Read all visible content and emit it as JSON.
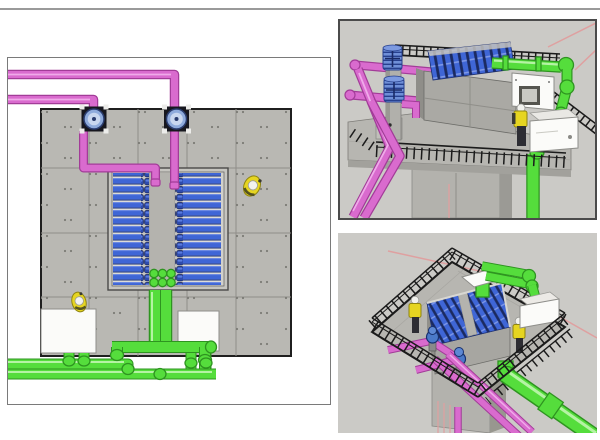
{
  "scene": {
    "name": "uv-disinfection-structure-3d-views",
    "view_count": 3
  },
  "panels": {
    "plan_view": {
      "name": "plan-view",
      "position": "left",
      "equipment": {
        "mixer_pumps": 2,
        "lamp_banks": 2,
        "lamp_modules_per_bank": 14,
        "influent_pipes_magenta": 2,
        "effluent_pipes_green": 2,
        "control_cabinets": 2,
        "workers": 2,
        "channel_drain_ports": 6
      }
    },
    "perspective_view_top": {
      "name": "elevated-structure-perspective",
      "position": "top-right",
      "equipment": {
        "vertical_pump_columns": 2,
        "lamp_modules_visible": 12,
        "control_cabinets": 2,
        "workers": 1,
        "magenta_drop_pipes": 2,
        "green_pipe_runs": 2
      }
    },
    "perspective_view_bottom": {
      "name": "platform-aerial-perspective",
      "position": "bottom-right",
      "equipment": {
        "valves": 2,
        "lamp_banks": 2,
        "white_boxes": 2,
        "workers": 2,
        "magenta_discharge_pipes": 2,
        "green_main_pipe": 1
      }
    }
  },
  "colors": {
    "viewport_bg": "#cbcac6",
    "concrete": "#b9b8b3",
    "concrete_dark": "#a2a19c",
    "concrete_seam": "#8f8e89",
    "concrete_edge": "#1f1f1f",
    "pipe_magenta": "#d96bce",
    "pipe_magenta_dark": "#a23c98",
    "pipe_magenta_light": "#efaae9",
    "pipe_green": "#55dd3c",
    "pipe_green_dark": "#2e9420",
    "pipe_green_light": "#b5f3a4",
    "module_blue": "#3f66d6",
    "module_blue_dark": "#1d2f70",
    "module_cap": "#2f4cae",
    "pump_ring": "#8fabdc",
    "pump_core": "#c9d7ef",
    "pump_base": "#17171f",
    "cabinet_white": "#fbfbf9",
    "worker_yellow": "#e6d521",
    "helmet_white": "#f2f2ee",
    "axis_salmon": "#dfa0a0",
    "railing_black": "#1b1b1b",
    "rule_gray": "#9a9a9a"
  }
}
